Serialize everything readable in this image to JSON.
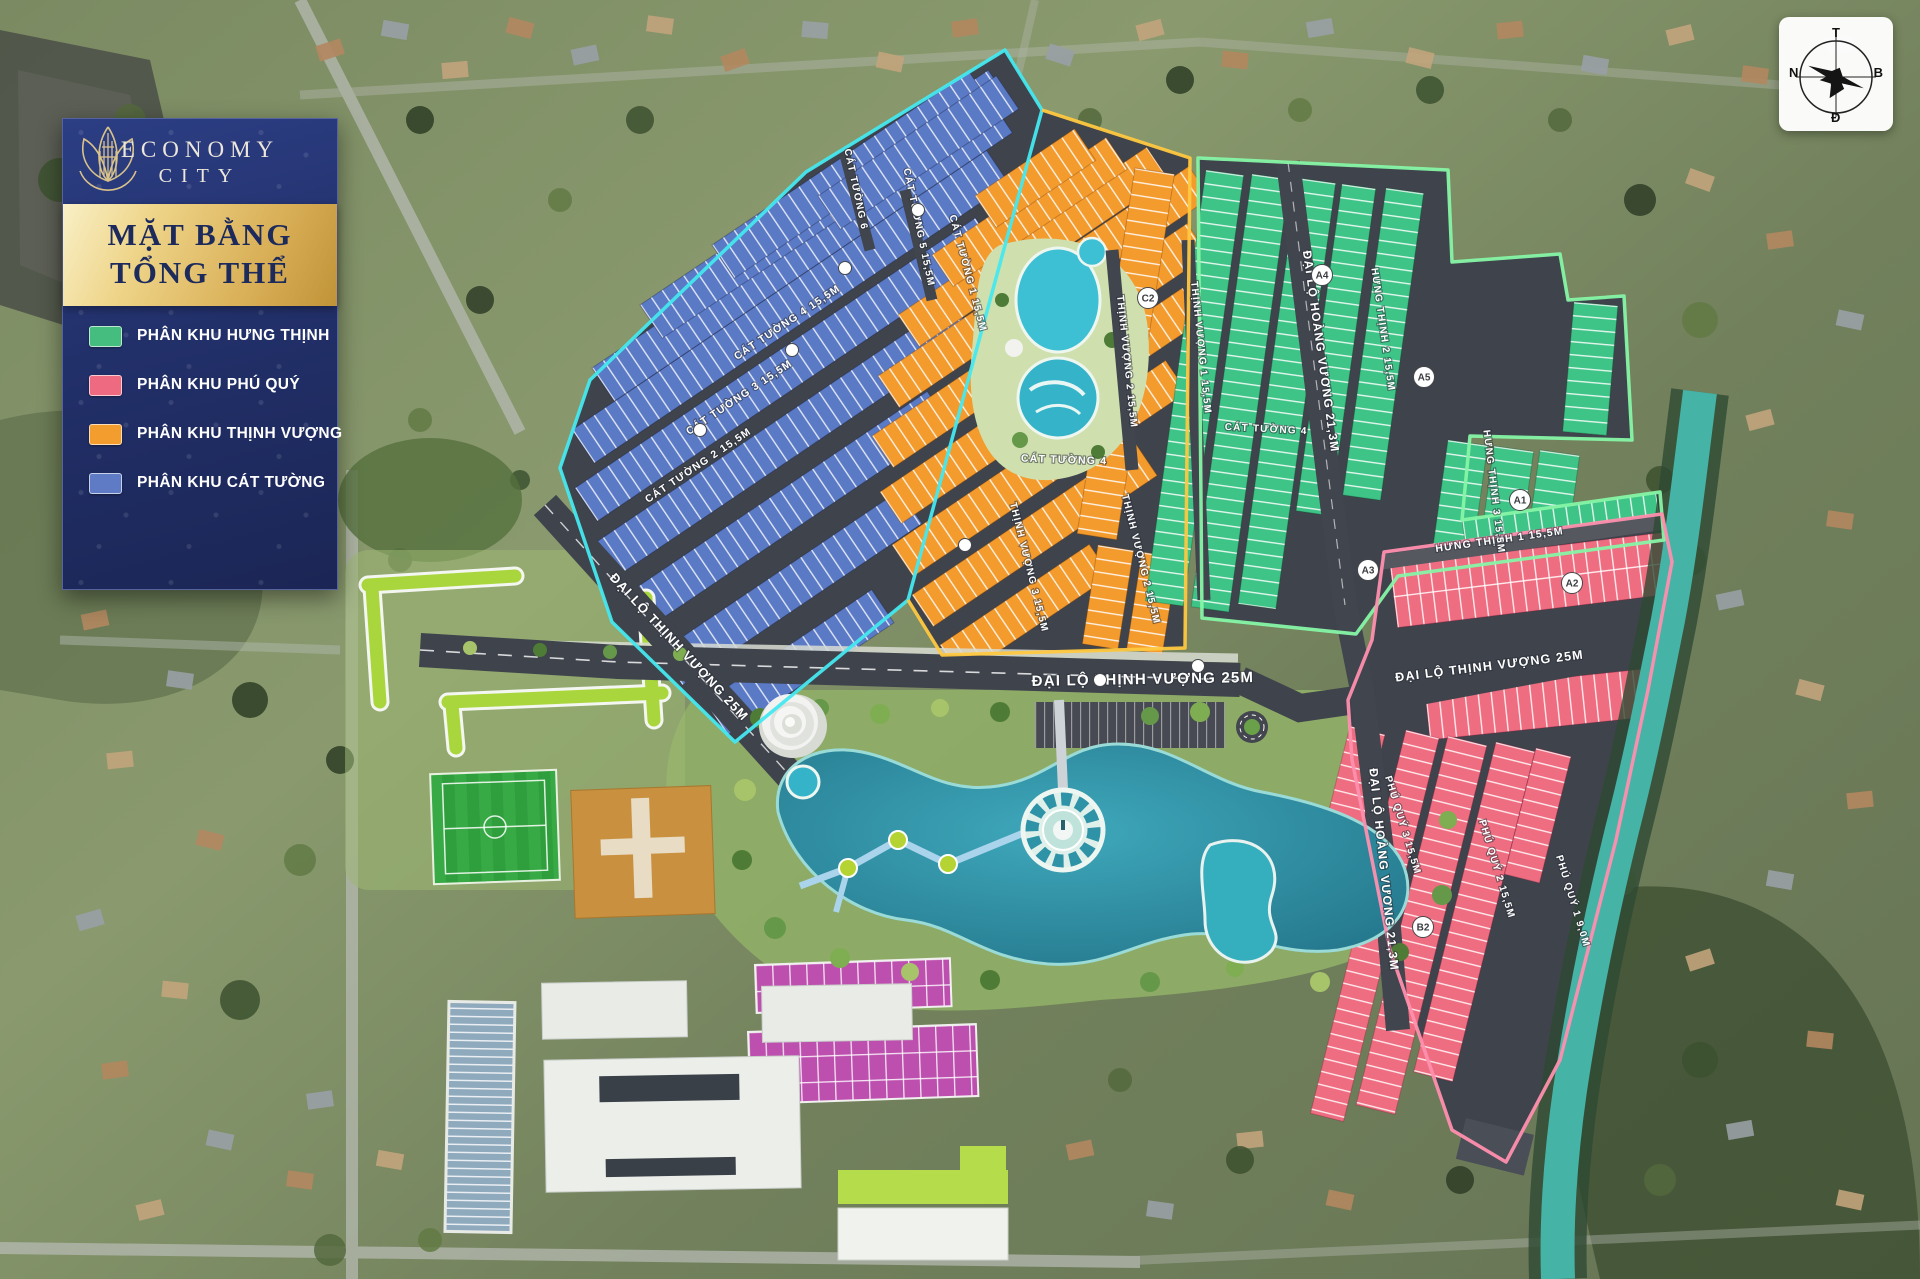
{
  "panel": {
    "brand_top": "ECONOMY",
    "brand_bottom": "CITY",
    "title_line1": "MẶT BẰNG",
    "title_line2": "TỔNG THỂ",
    "legend": [
      {
        "name": "hung-thinh",
        "label": "PHÂN KHU HƯNG THỊNH",
        "color": "#45bd7f"
      },
      {
        "name": "phu-quy",
        "label": "PHÂN KHU PHÚ QUÝ",
        "color": "#ee6a80"
      },
      {
        "name": "thinh-vuong",
        "label": "PHÂN KHU THỊNH VƯỢNG",
        "color": "#f49d2f"
      },
      {
        "name": "cat-tuong",
        "label": "PHÂN KHU CÁT TƯỜNG",
        "color": "#5f7bc6"
      }
    ]
  },
  "compass": {
    "top": "T",
    "left": "N",
    "right": "B",
    "bottom": "Đ"
  },
  "map": {
    "zone_colors": {
      "hung_thinh": "#3ec487",
      "phu_quy": "#ef6d80",
      "thinh_vuong": "#f49b2e",
      "cat_tuong": "#5b7ac6",
      "commercial_lots": "#bd4fae"
    },
    "road_labels": [
      {
        "text": "ĐẠI LỘ THỊNH VƯỢNG  25M",
        "x": 1143,
        "y": 684,
        "rot": -1,
        "size": 15
      },
      {
        "text": "ĐẠI LỘ THỊNH VƯỢNG  25M",
        "x": 676,
        "y": 650,
        "rot": 47,
        "size": 13
      },
      {
        "text": "ĐẠI LỘ THỊNH VƯỢNG  25M",
        "x": 1490,
        "y": 670,
        "rot": -7,
        "size": 12.5
      },
      {
        "text": "ĐẠI LỘ HOÀNG VƯƠNG  21,3M",
        "x": 1317,
        "y": 352,
        "rot": 82,
        "size": 12
      },
      {
        "text": "ĐẠI LỘ HOÀNG VƯƠNG  21,3M",
        "x": 1380,
        "y": 870,
        "rot": 84,
        "size": 12
      },
      {
        "text": "HƯNG THỊNH 1  15,5M",
        "x": 1500,
        "y": 543,
        "rot": -8,
        "size": 10.5
      },
      {
        "text": "HƯNG THỊNH 2  15,5M",
        "x": 1380,
        "y": 330,
        "rot": 82,
        "size": 10
      },
      {
        "text": "HƯNG THỊNH 3  15,5M",
        "x": 1491,
        "y": 492,
        "rot": 83,
        "size": 10
      },
      {
        "text": "CÁT TƯỜNG 1  15,5M",
        "x": 965,
        "y": 274,
        "rot": 75,
        "size": 10
      },
      {
        "text": "CÁT TƯỜNG 2  15,5M",
        "x": 700,
        "y": 468,
        "rot": -34,
        "size": 10.5
      },
      {
        "text": "CÁT TƯỜNG 3  15,5M",
        "x": 741,
        "y": 400,
        "rot": -34,
        "size": 10.5
      },
      {
        "text": "CÁT TƯỜNG 4  15,5M",
        "x": 789,
        "y": 325,
        "rot": -34,
        "size": 10.5
      },
      {
        "text": "CÁT TƯỜNG 5  15,5M",
        "x": 916,
        "y": 228,
        "rot": 78,
        "size": 10
      },
      {
        "text": "CÁT TƯỜNG 6",
        "x": 853,
        "y": 190,
        "rot": 78,
        "size": 10
      },
      {
        "text": "CÁT TƯỜNG 4",
        "x": 1064,
        "y": 463,
        "rot": 2,
        "size": 10.5
      },
      {
        "text": "CÁT TƯỜNG 4",
        "x": 1266,
        "y": 432,
        "rot": 3,
        "size": 10
      },
      {
        "text": "THỊNH VƯỢNG 1  15,5M",
        "x": 1198,
        "y": 348,
        "rot": 84,
        "size": 10
      },
      {
        "text": "THỊNH VƯỢNG 2  15,5M",
        "x": 1124,
        "y": 362,
        "rot": 84,
        "size": 10
      },
      {
        "text": "THỊNH VƯỢNG 2  15,5M",
        "x": 1138,
        "y": 560,
        "rot": 76,
        "size": 10
      },
      {
        "text": "THỊNH VƯỢNG 3  15,5M",
        "x": 1026,
        "y": 568,
        "rot": 76,
        "size": 10
      },
      {
        "text": "PHÚ QUÝ 1  9,0M",
        "x": 1570,
        "y": 902,
        "rot": 73,
        "size": 10
      },
      {
        "text": "PHÚ QUÝ 2  15,5M",
        "x": 1494,
        "y": 870,
        "rot": 73,
        "size": 10
      },
      {
        "text": "PHÚ QUÝ 3  15,5M",
        "x": 1400,
        "y": 826,
        "rot": 73,
        "size": 10
      }
    ],
    "block_badges": [
      {
        "text": "A4",
        "x": 1322,
        "y": 275
      },
      {
        "text": "A5",
        "x": 1424,
        "y": 377
      },
      {
        "text": "A3",
        "x": 1368,
        "y": 570
      },
      {
        "text": "A1",
        "x": 1520,
        "y": 500
      },
      {
        "text": "A2",
        "x": 1572,
        "y": 583
      },
      {
        "text": "B2",
        "x": 1423,
        "y": 927
      },
      {
        "text": "C2",
        "x": 1148,
        "y": 298
      },
      {
        "text": "",
        "x": 700,
        "y": 430
      },
      {
        "text": "",
        "x": 792,
        "y": 350
      },
      {
        "text": "",
        "x": 845,
        "y": 268
      },
      {
        "text": "",
        "x": 918,
        "y": 210
      },
      {
        "text": "",
        "x": 1100,
        "y": 680
      },
      {
        "text": "",
        "x": 1198,
        "y": 666
      },
      {
        "text": "",
        "x": 965,
        "y": 545
      }
    ]
  }
}
